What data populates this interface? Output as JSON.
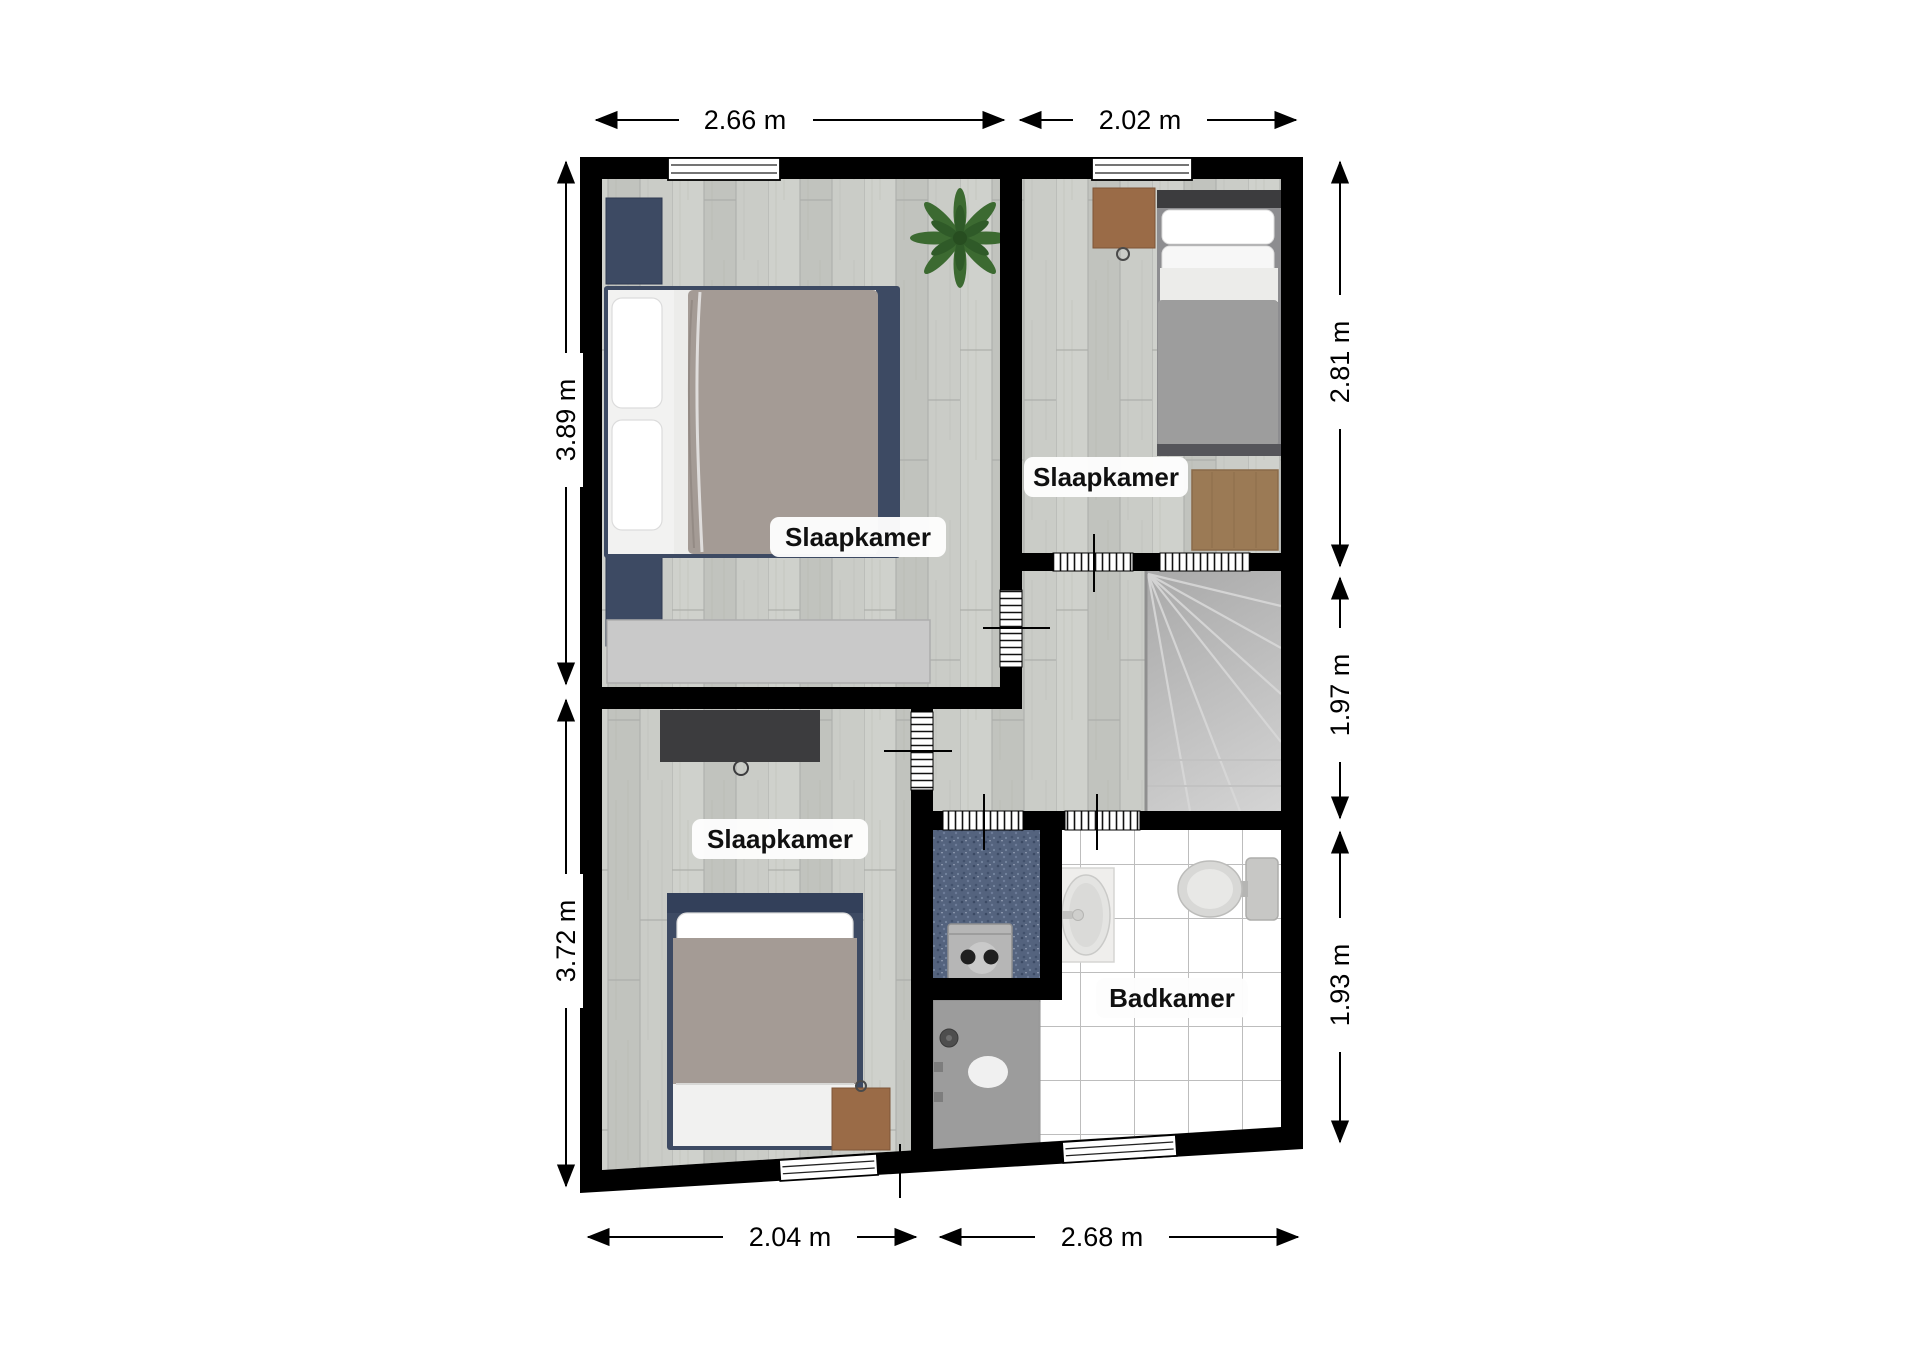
{
  "plan": {
    "room_labels": [
      "Slaapkamer",
      "Slaapkamer",
      "Slaapkamer",
      "Badkamer"
    ],
    "dimensions": {
      "top": [
        "2.66 m",
        "2.02 m"
      ],
      "bottom": [
        "2.04 m",
        "2.68 m"
      ],
      "left": [
        "3.89 m",
        "3.72 m"
      ],
      "right": [
        "2.81 m",
        "1.97 m",
        "1.93 m"
      ]
    },
    "colors": {
      "wall": "#000000",
      "wood_floor": "#c8cac5",
      "tile_floor": "#ffffff",
      "carpet_blue": "#54637e",
      "furniture_navy": "#3d4a63",
      "furniture_charcoal": "#3c3c3e",
      "furniture_wood": "#9a6b47",
      "duvet_grey": "#a49b95",
      "duvet_cool_grey": "#9d9d9d",
      "plant_green": "#3c6a31",
      "stair_grey": "#c3c3c3",
      "shower_grey": "#9c9c9c"
    }
  }
}
